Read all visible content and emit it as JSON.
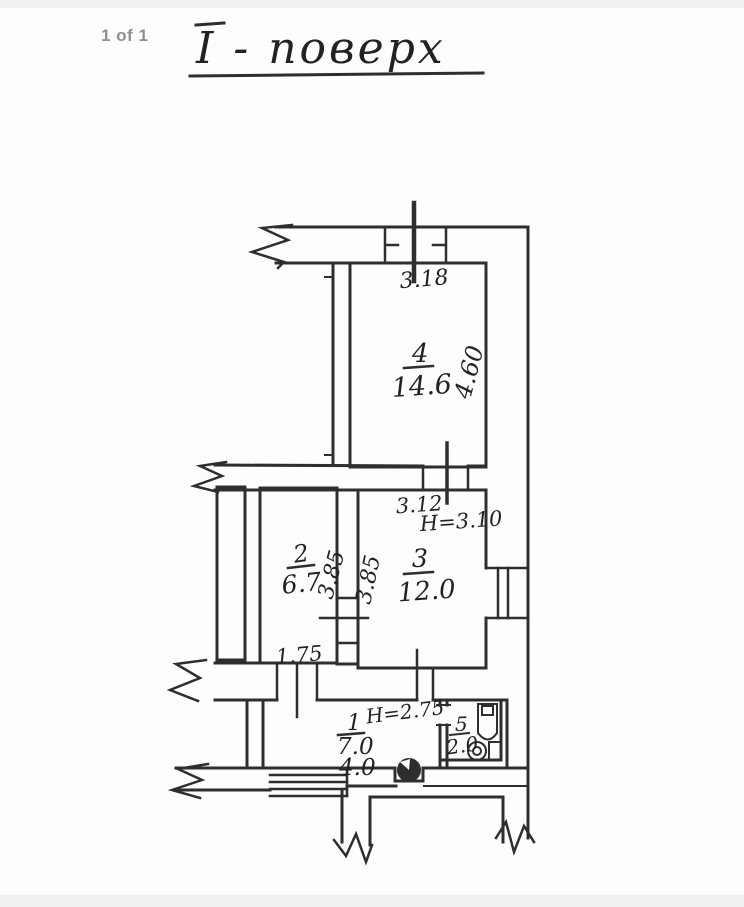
{
  "viewer": {
    "page_indicator": "1 of 1"
  },
  "drawing": {
    "title": "І - поверх",
    "ink_color": "#2e2e2e",
    "rooms": [
      {
        "number": "4",
        "area": "14.6",
        "width_dim": "3.18",
        "depth_dim": "4.60"
      },
      {
        "number": "2",
        "area": "6.7",
        "depth_dim": "3.85"
      },
      {
        "number": "3",
        "area": "12.0",
        "width_dim": "3.12",
        "ceiling_height": "Н=3.10",
        "depth_dim": "3.85"
      },
      {
        "number": "1",
        "area": "7.0",
        "area_secondary": "4.0",
        "ceiling_height": "Н=2.75",
        "opening_dim": "1.75"
      },
      {
        "number": "5",
        "area": "2.0"
      }
    ],
    "fixtures": [
      "toilet",
      "washbasin",
      "stove"
    ]
  }
}
